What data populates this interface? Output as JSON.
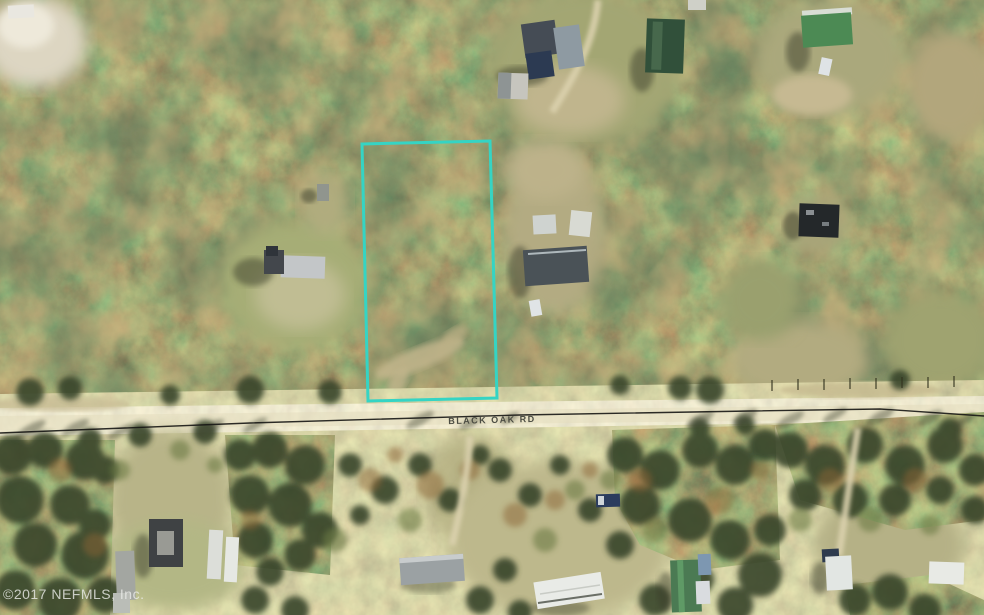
{
  "photo": {
    "kind": "aerial-parcel-photo",
    "road_label": "BLACK OAK RD",
    "watermark": "©2017 NEFMLS, Inc.",
    "colors": {
      "parcel_boundary": "#35d4c4",
      "power_line": "#161614",
      "road_label_text": "#4b4c42",
      "watermark_text": "#ecedea",
      "road_surface": "#d9cf9e",
      "forest_base": "#5f6b32"
    }
  }
}
